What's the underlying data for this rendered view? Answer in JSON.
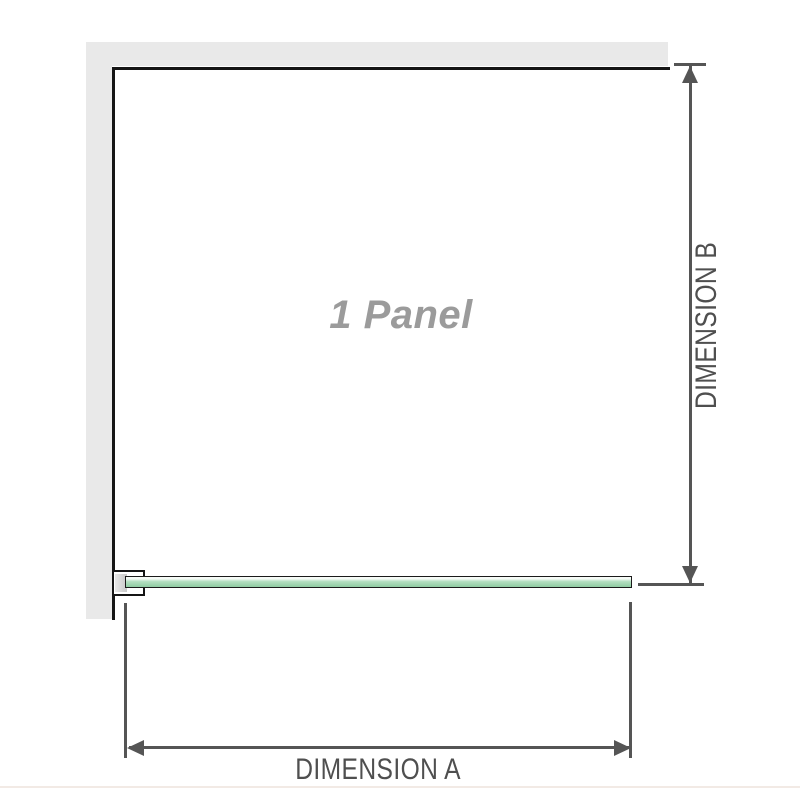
{
  "diagram": {
    "title": "1 Panel",
    "dimensions": [
      {
        "id": "A",
        "label": "DIMENSION A"
      },
      {
        "id": "B",
        "label": "DIMENSION B"
      }
    ]
  },
  "colors": {
    "wall_fill": "#e9e9e9",
    "wall_line": "#151515",
    "dim_line": "#555555",
    "dim_label": "#4f4f4f",
    "panel_label": "#9b9b9b",
    "glass_border": "#1b1b1b",
    "glass_top": "#f6fbf7",
    "glass_mid": "#b4dfc1",
    "glass_bottom": "#8fcca2",
    "bracket_fill": "#ffffff",
    "insert_light": "#e8e8e8",
    "insert_dark": "#c9c9c9",
    "footer_line": "#f2eae5"
  }
}
